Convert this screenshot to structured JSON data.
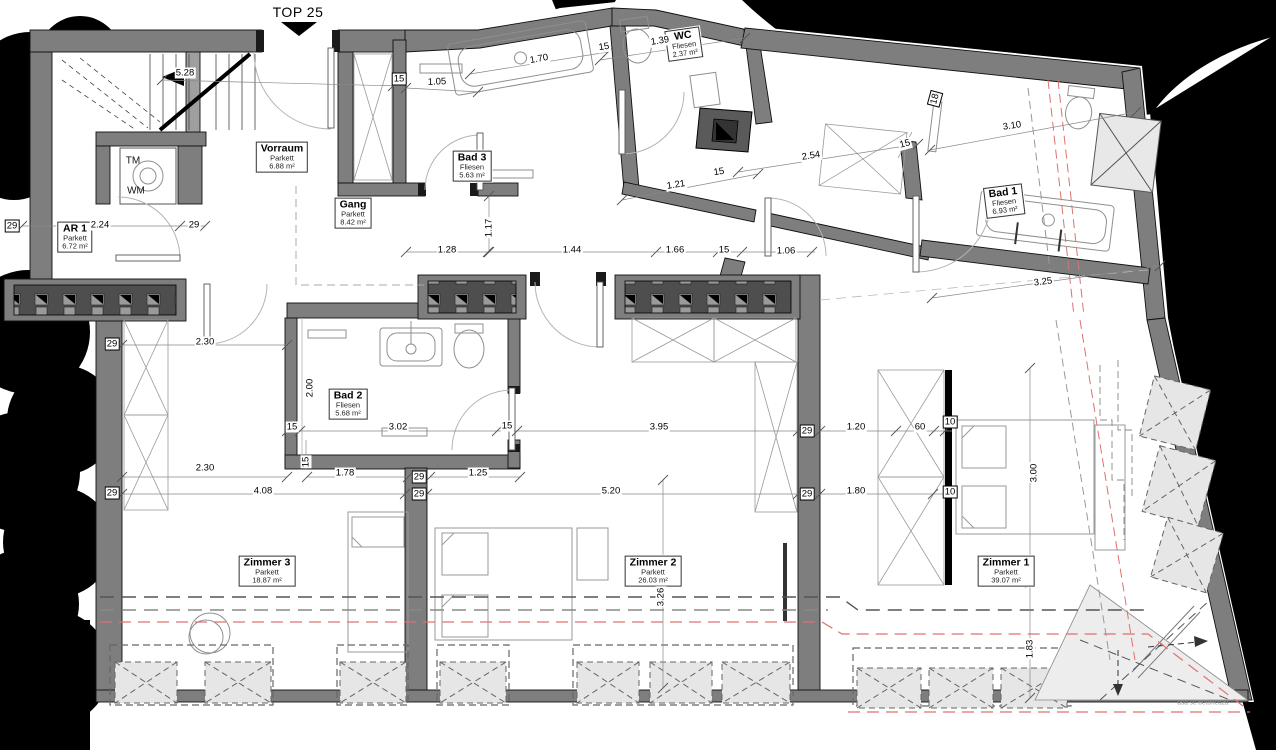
{
  "title": {
    "label": "TOP 25"
  },
  "rooms": [
    {
      "name": "Vorraum",
      "floor": "Parkett",
      "area": "6.88 m²",
      "x": 282,
      "y": 157,
      "rot": 0
    },
    {
      "name": "Gang",
      "floor": "Parkett",
      "area": "8.42 m²",
      "x": 353,
      "y": 213,
      "rot": 0
    },
    {
      "name": "AR 1",
      "floor": "Parkett",
      "area": "6.72 m²",
      "x": 75,
      "y": 237,
      "rot": 0
    },
    {
      "name": "Bad 3",
      "floor": "Fliesen",
      "area": "5.63 m²",
      "x": 472,
      "y": 166,
      "rot": 0
    },
    {
      "name": "WC",
      "floor": "Fliesen",
      "area": "2.37 m²",
      "x": 684,
      "y": 44,
      "rot": -8
    },
    {
      "name": "Bad 1",
      "floor": "Fliesen",
      "area": "6.93 m²",
      "x": 1004,
      "y": 201,
      "rot": -7
    },
    {
      "name": "Bad 2",
      "floor": "Fliesen",
      "area": "5.68 m²",
      "x": 348,
      "y": 404,
      "rot": 0
    },
    {
      "name": "Zimmer 3",
      "floor": "Parkett",
      "area": "18.87 m²",
      "x": 267,
      "y": 571,
      "rot": 0
    },
    {
      "name": "Zimmer 2",
      "floor": "Parkett",
      "area": "26.03 m²",
      "x": 653,
      "y": 571,
      "rot": 0
    },
    {
      "name": "Zimmer 1",
      "floor": "Parkett",
      "area": "39.07 m²",
      "x": 1006,
      "y": 571,
      "rot": 0
    }
  ],
  "dimensions": [
    {
      "t": "5.28",
      "x": 185,
      "y": 73,
      "rot": 0,
      "boxed": false
    },
    {
      "t": "15",
      "x": 399,
      "y": 79,
      "rot": 0,
      "boxed": true
    },
    {
      "t": "1.05",
      "x": 437,
      "y": 82,
      "rot": -2,
      "boxed": false
    },
    {
      "t": "1.70",
      "x": 539,
      "y": 59,
      "rot": -10,
      "boxed": false
    },
    {
      "t": "15",
      "x": 604,
      "y": 47,
      "rot": -9,
      "boxed": false
    },
    {
      "t": "1.39",
      "x": 660,
      "y": 41,
      "rot": -9,
      "boxed": false
    },
    {
      "t": "2.54",
      "x": 811,
      "y": 156,
      "rot": -9,
      "boxed": false
    },
    {
      "t": "1.21",
      "x": 676,
      "y": 185,
      "rot": -9,
      "boxed": false
    },
    {
      "t": "15",
      "x": 719,
      "y": 172,
      "rot": -9,
      "boxed": false
    },
    {
      "t": "15",
      "x": 905,
      "y": 144,
      "rot": -15,
      "boxed": false
    },
    {
      "t": "18",
      "x": 935,
      "y": 99,
      "rot": -75,
      "boxed": true
    },
    {
      "t": "3.10",
      "x": 1012,
      "y": 126,
      "rot": -8,
      "boxed": false
    },
    {
      "t": "3.25",
      "x": 1043,
      "y": 282,
      "rot": -7,
      "boxed": false
    },
    {
      "t": "29",
      "x": 12,
      "y": 226,
      "rot": 0,
      "boxed": true
    },
    {
      "t": "2.24",
      "x": 100,
      "y": 225,
      "rot": 0,
      "boxed": false
    },
    {
      "t": "29",
      "x": 194,
      "y": 225,
      "rot": 0,
      "boxed": false
    },
    {
      "t": "1.17",
      "x": 489,
      "y": 228,
      "rot": -90,
      "boxed": false
    },
    {
      "t": "1.28",
      "x": 447,
      "y": 250,
      "rot": 0,
      "boxed": false
    },
    {
      "t": "1.44",
      "x": 572,
      "y": 250,
      "rot": 0,
      "boxed": false
    },
    {
      "t": "1.66",
      "x": 675,
      "y": 250,
      "rot": 0,
      "boxed": false
    },
    {
      "t": "15",
      "x": 724,
      "y": 250,
      "rot": 0,
      "boxed": false
    },
    {
      "t": "1.06",
      "x": 786,
      "y": 251,
      "rot": 0,
      "boxed": false
    },
    {
      "t": "29",
      "x": 112,
      "y": 344,
      "rot": 0,
      "boxed": true
    },
    {
      "t": "2.30",
      "x": 205,
      "y": 342,
      "rot": 0,
      "boxed": false
    },
    {
      "t": "2.00",
      "x": 310,
      "y": 388,
      "rot": -90,
      "boxed": false
    },
    {
      "t": "15",
      "x": 292,
      "y": 427,
      "rot": 0,
      "boxed": false
    },
    {
      "t": "3.02",
      "x": 398,
      "y": 427,
      "rot": 0,
      "boxed": false
    },
    {
      "t": "15",
      "x": 507,
      "y": 426,
      "rot": 0,
      "boxed": false
    },
    {
      "t": "3.95",
      "x": 659,
      "y": 427,
      "rot": 0,
      "boxed": false
    },
    {
      "t": "29",
      "x": 807,
      "y": 431,
      "rot": 0,
      "boxed": true
    },
    {
      "t": "1.20",
      "x": 856,
      "y": 427,
      "rot": 0,
      "boxed": false
    },
    {
      "t": "60",
      "x": 920,
      "y": 427,
      "rot": 0,
      "boxed": false
    },
    {
      "t": "10",
      "x": 950,
      "y": 422,
      "rot": 0,
      "boxed": true
    },
    {
      "t": "2.30",
      "x": 205,
      "y": 468,
      "rot": 0,
      "boxed": false
    },
    {
      "t": "15",
      "x": 306,
      "y": 462,
      "rot": -90,
      "boxed": false
    },
    {
      "t": "1.78",
      "x": 345,
      "y": 473,
      "rot": 0,
      "boxed": false
    },
    {
      "t": "29",
      "x": 419,
      "y": 477,
      "rot": 0,
      "boxed": true
    },
    {
      "t": "1.25",
      "x": 478,
      "y": 473,
      "rot": 0,
      "boxed": false
    },
    {
      "t": "4.08",
      "x": 263,
      "y": 491,
      "rot": 0,
      "boxed": false
    },
    {
      "t": "29",
      "x": 112,
      "y": 493,
      "rot": 0,
      "boxed": true
    },
    {
      "t": "29",
      "x": 419,
      "y": 494,
      "rot": 0,
      "boxed": true
    },
    {
      "t": "5.20",
      "x": 611,
      "y": 491,
      "rot": 0,
      "boxed": false
    },
    {
      "t": "29",
      "x": 807,
      "y": 494,
      "rot": 0,
      "boxed": true
    },
    {
      "t": "1.80",
      "x": 856,
      "y": 491,
      "rot": 0,
      "boxed": false
    },
    {
      "t": "10",
      "x": 950,
      "y": 492,
      "rot": 0,
      "boxed": true
    },
    {
      "t": "3.00",
      "x": 1034,
      "y": 473,
      "rot": -90,
      "boxed": false
    },
    {
      "t": "3.26",
      "x": 661,
      "y": 597,
      "rot": -90,
      "boxed": false
    },
    {
      "t": "1.83",
      "x": 1030,
      "y": 649,
      "rot": -90,
      "boxed": false
    }
  ],
  "misc_labels": [
    {
      "t": "TM",
      "x": 133,
      "y": 161
    },
    {
      "t": "WM",
      "x": 136,
      "y": 191
    }
  ],
  "annotations": [
    {
      "t": "asa se betoneaza",
      "x": 1203,
      "y": 703
    }
  ],
  "colors": {
    "wall": "#7e7e7e",
    "install_band": "#4e4e4e",
    "skylight_fill": "#e6e6e6",
    "roof_edge_red": "#e07070",
    "background_mask": "#000000"
  }
}
